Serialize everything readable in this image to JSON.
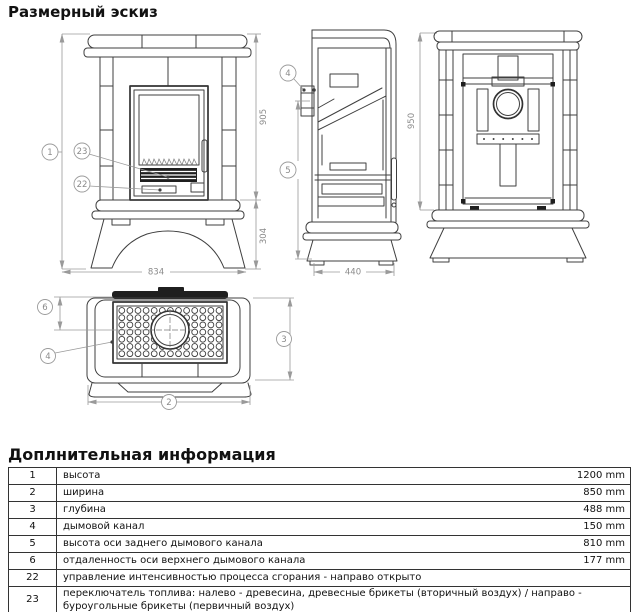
{
  "page": {
    "title_sketch": "Размерный эскиз",
    "title_info": "Доплнительная информация"
  },
  "drawing": {
    "front_view": {
      "dim_height": "905",
      "dim_base": "304",
      "dim_width": "834",
      "callout_1": "1",
      "callout_22": "22",
      "callout_23": "23"
    },
    "side_view": {
      "dim_depth": "440",
      "callout_4": "4",
      "callout_5": "5"
    },
    "rear_view": {
      "dim_height": "950"
    },
    "top_view": {
      "callout_2": "2",
      "callout_3": "3",
      "callout_4": "4",
      "callout_6": "6"
    }
  },
  "table": {
    "rows": [
      {
        "num": "1",
        "desc": "высота",
        "value": "1200 mm"
      },
      {
        "num": "2",
        "desc": "ширина",
        "value": "850 mm"
      },
      {
        "num": "3",
        "desc": "глубина",
        "value": "488 mm"
      },
      {
        "num": "4",
        "desc": "дымовой канал",
        "value": "150 mm"
      },
      {
        "num": "5",
        "desc": "высота оси заднего дымового канала",
        "value": "810 mm"
      },
      {
        "num": "6",
        "desc": "отдаленность оси верхнего дымового канала",
        "value": "177 mm"
      },
      {
        "num": "22",
        "desc": "управление интенсивностью процесса сгорания - направо открыто",
        "value": ""
      },
      {
        "num": "23",
        "desc": "переключатель топлива: налево - древесина, древесные брикеты (вторичный воздух) / направо - буроугольные брикеты (первичный воздух)",
        "value": ""
      }
    ]
  }
}
